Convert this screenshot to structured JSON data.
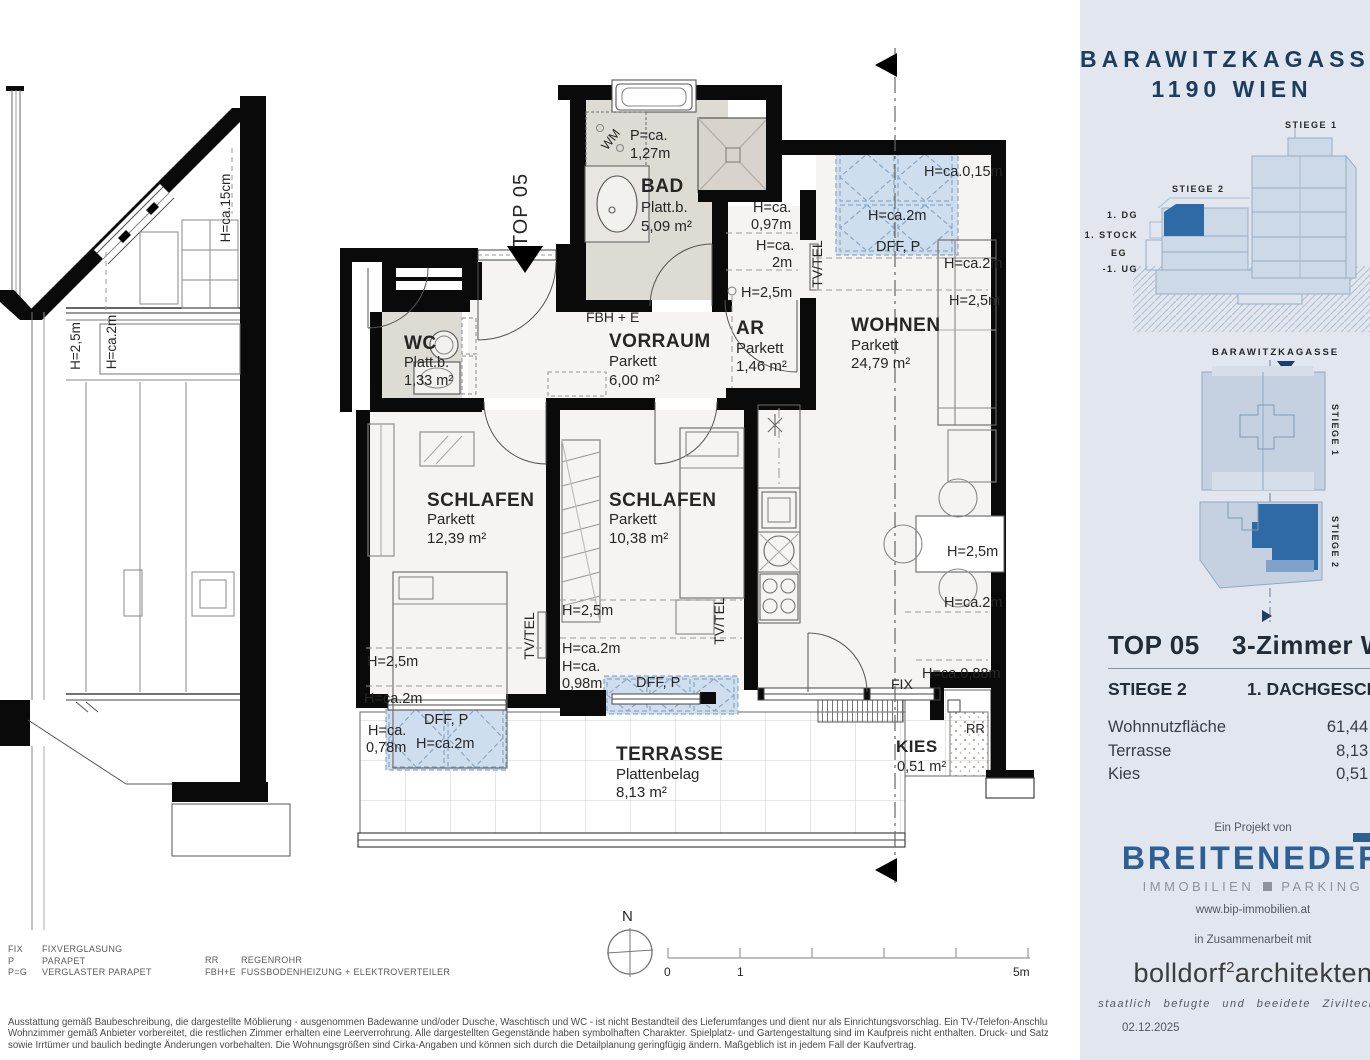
{
  "plan": {
    "marker": "TOP 05",
    "compass": "N",
    "scale": {
      "t0": "0",
      "t1": "1",
      "t5": "5m"
    },
    "rooms": {
      "bad": {
        "name": "BAD",
        "finish": "Platt.b.",
        "area": "5,09 m²"
      },
      "wc": {
        "name": "WC",
        "finish": "Platt.b.",
        "area": "1,33 m²"
      },
      "vorraum": {
        "name": "VORRAUM",
        "finish": "Parkett",
        "area": "6,00 m²"
      },
      "ar": {
        "name": "AR",
        "finish": "Parkett",
        "area": "1,46 m²"
      },
      "wohnen": {
        "name": "WOHNEN",
        "finish": "Parkett",
        "area": "24,79 m²"
      },
      "schlafen1": {
        "name": "SCHLAFEN",
        "finish": "Parkett",
        "area": "12,39 m²"
      },
      "schlafen2": {
        "name": "SCHLAFEN",
        "finish": "Parkett",
        "area": "10,38 m²"
      },
      "terrasse": {
        "name": "TERRASSE",
        "finish": "Plattenbelag",
        "area": "8,13 m²"
      },
      "kies": {
        "name": "KIES",
        "area": "0,51 m²"
      }
    },
    "labels": {
      "h25": "H=2,5m",
      "h2": "H=ca.2m",
      "hca": "H=ca.",
      "v097": "0,97m",
      "v2m": "2m",
      "v078": "0,78m",
      "v098": "0,98m",
      "h015": "H=ca.0,15m",
      "h088": "H=ca.0,88m",
      "dff": "DFF, P",
      "tvtel": "TV/TEL",
      "wm": "WM",
      "fix": "FIX",
      "rr": "RR",
      "pca": "P=ca.",
      "v127": "1,27m",
      "fbhe": "FBH + E"
    }
  },
  "section_view": {
    "h15cm": "H=ca.15cm",
    "h25": "H=2,5m",
    "h2": "H=ca.2m"
  },
  "panel": {
    "title1": "BARAWITZKAGASSE",
    "title2": "1190 WIEN",
    "elevation": {
      "stiege1": "STIEGE 1",
      "stiege2": "STIEGE 2",
      "floor_dg": "1. DG",
      "floor_stock": "1. STOCK",
      "floor_eg": "EG",
      "floor_ug": "-1. UG"
    },
    "siteplan": {
      "street": "BARAWITZKAGASSE",
      "stiege1": "STIEGE 1",
      "stiege2": "STIEGE 2"
    },
    "unit": {
      "top": "TOP 05",
      "type": "3-Zimmer Whg",
      "stiege": "STIEGE 2",
      "level": "1. DACHGESCHOSS",
      "rows": [
        {
          "label": "Wohnnutzfläche",
          "value": "61,44 m²"
        },
        {
          "label": "Terrasse",
          "value": "8,13 m²"
        },
        {
          "label": "Kies",
          "value": "0,51 m²"
        }
      ]
    },
    "project": {
      "intro": "Ein Projekt von",
      "brand": "BREITENEDER",
      "brand_sub_1": "IMMOBILIEN",
      "brand_sub_2": "PARKING",
      "url": "www.bip-immobilien.at",
      "coop": "in Zusammenarbeit mit",
      "arch_1": "bolldorf",
      "arch_sup": "2",
      "arch_2": "architekten",
      "arch_sub": "staatlich befugte und beeidete Ziviltechniker",
      "date": "02.12.2025"
    }
  },
  "legend": {
    "left": [
      {
        "abbr": "FIX",
        "label": "FIXVERGLASUNG"
      },
      {
        "abbr": "P",
        "label": "PARAPET"
      },
      {
        "abbr": "P=G",
        "label": "VERGLASTER PARAPET"
      }
    ],
    "right": [
      {
        "abbr": "RR",
        "label": "REGENROHR"
      },
      {
        "abbr": "FBH+E",
        "label": "FUSSBODENHEIZUNG + ELEKTROVERTEILER"
      }
    ]
  },
  "disclaimer": {
    "line1": "Ausstattung gemäß Baubeschreibung, die dargestellte Möblierung - ausgenommen Badewanne und/oder Dusche, Waschtisch und WC - ist nicht Bestandteil des Lieferumfanges und dient nur als Einrichtungsvorschlag. Ein TV-/Telefon-Anschluss wird im",
    "line2": "Wohnzimmer gemäß Anbieter vorbereitet, die restlichen Zimmer erhalten eine Leerverrohrung. Alle dargestellten Gegenstände haben symbolhaften Charakter. Spielplatz- und Gartengestaltung sind im Kaufpreis nicht enthalten. Druck- und Satzfehler,",
    "line3": "sowie Irrtümer und baulich bedingte Änderungen vorbehalten. Die Wohnungsgrößen sind Cirka-Angaben und können sich durch die Detailplanung geringfügig ändern. Maßgeblich ist in jedem Fall der Kaufvertrag."
  }
}
